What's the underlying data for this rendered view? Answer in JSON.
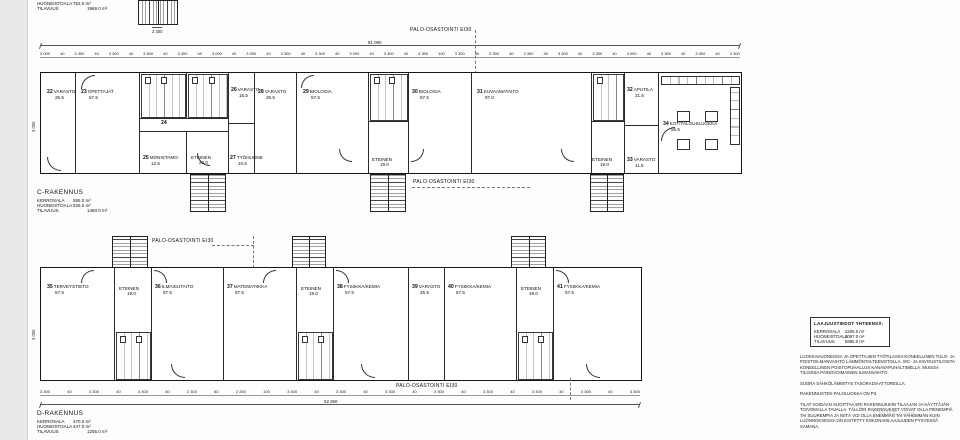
{
  "page": {
    "fire_label": "PALO-OSASTOINTI EI30",
    "watermark": "123RF.com"
  },
  "top_partial": {
    "rows": [
      {
        "label": "HUONEISTOALA",
        "value": "752.0 m²"
      },
      {
        "label": "TILAVUUS",
        "value": "1969.0 m³"
      }
    ],
    "stair_dim": "2 300"
  },
  "building_c": {
    "title": "C-RAKENNUS",
    "total_dim": "81 090",
    "side_dim": "3 000",
    "dims": [
      "3 000",
      "40",
      "3 300",
      "40",
      "3 300",
      "40",
      "3 500",
      "40",
      "3 300",
      "40",
      "3 000",
      "40",
      "3 000",
      "40",
      "3 300",
      "40",
      "3 300",
      "40",
      "3 000",
      "40",
      "3 300",
      "40",
      "3 300",
      "100",
      "3 300",
      "40",
      "3 300",
      "40",
      "3 300",
      "40",
      "3 300",
      "40",
      "3 300",
      "40",
      "3 000",
      "40",
      "3 300",
      "40",
      "3 300",
      "40",
      "3 300"
    ],
    "stats": [
      {
        "label": "KERROSALA",
        "value": "555.0 m²"
      },
      {
        "label": "HUONEISTOALA",
        "value": "526.0 m²"
      },
      {
        "label": "TILAVUUS",
        "value": "1480.0 m³"
      }
    ],
    "rooms": {
      "r22": {
        "num": "22",
        "name": "VARASTO",
        "area": "25.5"
      },
      "r23": {
        "num": "23",
        "name": "OPETTAJAT",
        "area": "57.5"
      },
      "r24": {
        "num": "24",
        "name": "",
        "area": ""
      },
      "r25": {
        "num": "25",
        "name": "MONISTAMO",
        "area": "12.5"
      },
      "ete1": {
        "num": "",
        "name": "ETEINEN",
        "area": "20.0"
      },
      "r26": {
        "num": "26",
        "name": "VARASTO",
        "area": "15.5"
      },
      "r27": {
        "num": "27",
        "name": "TYÖHUONE",
        "area": "10.5"
      },
      "r28": {
        "num": "28",
        "name": "VARASTO",
        "area": "25.5"
      },
      "r29": {
        "num": "29",
        "name": "BIOLOGIA",
        "area": "57.5"
      },
      "ete2": {
        "num": "",
        "name": "ETEINEN",
        "area": "19.0"
      },
      "r30": {
        "num": "30",
        "name": "BIOLOGIA",
        "area": "57.5"
      },
      "r31": {
        "num": "31",
        "name": "KUVAAMATAITO",
        "area": "97.0"
      },
      "r32": {
        "num": "32",
        "name": "APUTILA",
        "area": "21.5"
      },
      "ete3": {
        "num": "",
        "name": "ETEINEN",
        "area": "19.0"
      },
      "r33": {
        "num": "33",
        "name": "VARASTO",
        "area": "11.5"
      },
      "r34": {
        "num": "34",
        "name": "KOTITALOUSLUOKKA",
        "area": "55.5"
      }
    }
  },
  "building_d": {
    "title": "D-RAKENNUS",
    "total_dim": "52 260",
    "side_dim": "3 000",
    "dims": [
      "3 300",
      "40",
      "3 300",
      "40",
      "3 300",
      "40",
      "2 300",
      "80",
      "2 250",
      "100",
      "3 300",
      "40",
      "3 300",
      "40",
      "3 300",
      "40",
      "3 300",
      "40",
      "3 300",
      "40",
      "3 300",
      "40",
      "3 300",
      "40",
      "3 300"
    ],
    "stats": [
      {
        "label": "KERROSALA",
        "value": "470.0 m²"
      },
      {
        "label": "HUONEISTOALA",
        "value": "447.0 m²"
      },
      {
        "label": "TILAVUUS",
        "value": "1255.0 m³"
      }
    ],
    "rooms": {
      "r35": {
        "num": "35",
        "name": "TERVEYSTIETO",
        "area": "57.5"
      },
      "eteD1": {
        "num": "",
        "name": "ETEINEN",
        "area": "19.0"
      },
      "r36": {
        "num": "36",
        "name": "ILMAISUTAITO",
        "area": "57.5"
      },
      "r37": {
        "num": "37",
        "name": "MATEMATIIKKA",
        "area": "57.5"
      },
      "eteD2": {
        "num": "",
        "name": "ETEINEN",
        "area": "19.0"
      },
      "r38": {
        "num": "38",
        "name": "FYSIIKKA/KEMIA",
        "area": "57.5"
      },
      "r39": {
        "num": "39",
        "name": "VARASTO",
        "area": "25.5"
      },
      "r40": {
        "num": "40",
        "name": "FYSIIKKA/KEMIA",
        "area": "57.5"
      },
      "eteD3": {
        "num": "",
        "name": "ETEINEN",
        "area": "19.0"
      },
      "r41": {
        "num": "41",
        "name": "FYSIIKKA/KEMIA",
        "area": "57.5"
      }
    }
  },
  "summary": {
    "title": "LAAJUUSTIEDOT YHTEENSÄ:",
    "rows": [
      {
        "label": "KERROSALA",
        "value": "2205.0 m²"
      },
      {
        "label": "HUONEISTOALA",
        "value": "2097.0 m²"
      },
      {
        "label": "TILAVUUS",
        "value": "5885.0 m³"
      }
    ]
  },
  "notes": [
    "LUOKKAHUONEISSA JA OPETTAJIEN TYÖTILASSA KONEELLINEN TULO- JA POISTOILMANVAIHTO LÄMMÖNTALTEENOTOLLA. WC- JA SIIVOUSTILOISTA KONEELLINEN POISTOPUHALLUS KANAVAPUHALTIMELLA. MUISSA TILOISSA PAINOVOIMAINEN ILMANVAIHTO.",
    "SUORA SÄHKÖLÄMMITYS TASORADIAATTOREILLA.",
    "RAKENNUSTEN PALOLUOKKA ON P3.",
    "TILAT VOIDAAN SIJOITTAA ERI RAKENNUKSIIN TILAAJAN JA KÄYTTÄJÄN TOIVOMALLA TAVALLA. TÄLLÖIN RAKENNUKSET VOIVAT OLLA PIENEMPIÄ TAI SUUREMPIA JA NIITÄ VOI OLLA ENEMMÄN TAI VÄHEMMÄN KUIN LUONNOKSESSA ON ESITETTY KOKONAISLAAJUUDEN PYSYESSÄ SAMANA."
  ]
}
